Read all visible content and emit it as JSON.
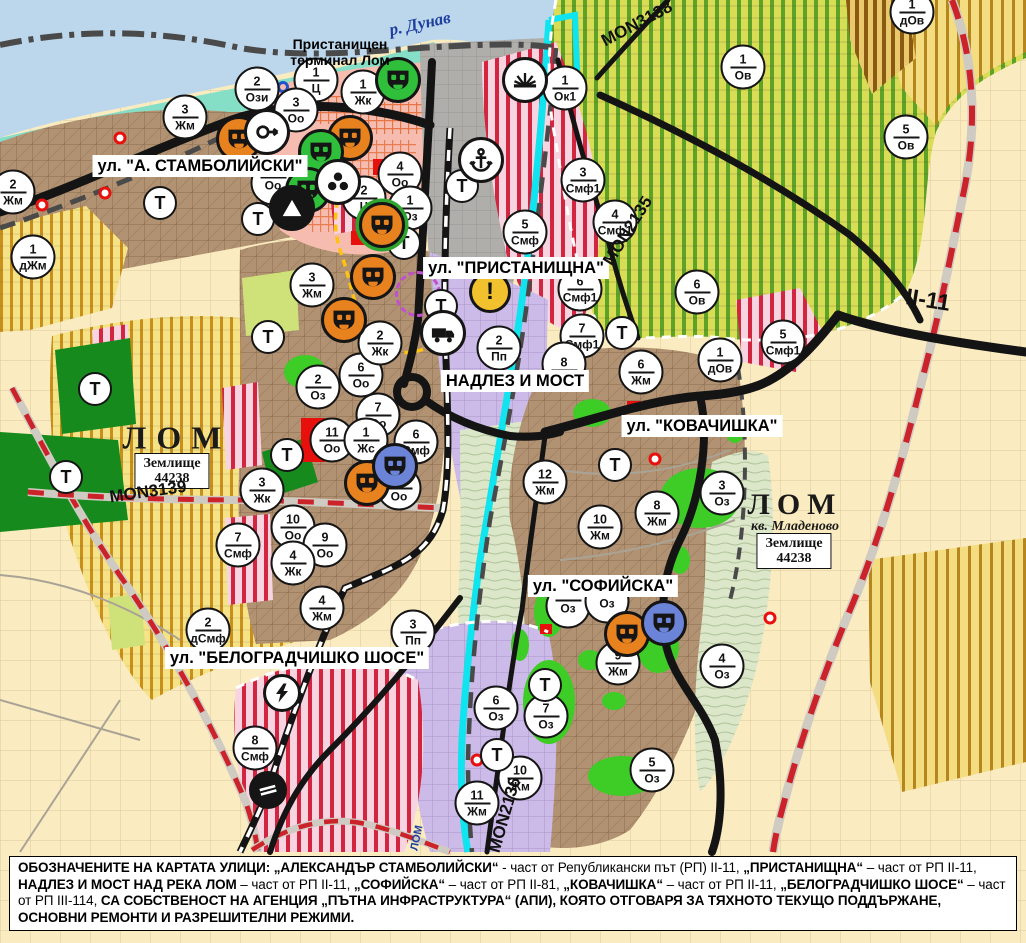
{
  "colors": {
    "water": "#BCD7EC",
    "shore": "#85DEC6",
    "port_gray": "#B0AEAB",
    "plain": "#FAEBC0",
    "brown_urban": "#B19272",
    "purple_zone": "#CCBAE8",
    "salmon_center": "#F6BCB0",
    "terrace": "#DCE7CA",
    "yellow_hatch_bg": "#F6E387",
    "yellow_hatch_stripe": "#C98F1B",
    "green_hatch_bg": "#D9DC55",
    "green_hatch_stripe": "#5EA227",
    "ochre_hatch_bg": "#F4DC80",
    "ochre_hatch_stripe": "#B5851E",
    "red_stripe_bg": "#F7D4DF",
    "red_stripe": "#D22640",
    "bright_green": "#3ECC27",
    "dark_green": "#168A1C",
    "lime": "#CFE27A",
    "red_patch": "#E8100C",
    "cyan_river": "#10E4EF",
    "road_black": "#141414",
    "road_red_dash": "#CC2229",
    "marker_orange": "#E8821E",
    "marker_green": "#2FBF3A",
    "marker_blue": "#6C84D8",
    "warn_yellow": "#F2C12E"
  },
  "labels": [
    {
      "t": "ул. \"А. СТАМБОЛИЙСКИ\"",
      "x": 200,
      "y": 166,
      "cls": "street",
      "rot": 0,
      "name": "street-label-stamboliyski"
    },
    {
      "t": "ул. \"ПРИСТАНИЩНА\"",
      "x": 516,
      "y": 268,
      "cls": "street",
      "rot": 0,
      "name": "street-label-pristanishtna"
    },
    {
      "t": "НАДЛЕЗ И МОСТ",
      "x": 515,
      "y": 381,
      "cls": "street",
      "rot": 0,
      "name": "street-label-nadlez-i-most"
    },
    {
      "t": "ул. \"КОВАЧИШКА\"",
      "x": 702,
      "y": 426,
      "cls": "street",
      "rot": 0,
      "name": "street-label-kovachishka"
    },
    {
      "t": "ул. \"СОФИЙСКА\"",
      "x": 603,
      "y": 586,
      "cls": "street",
      "rot": 0,
      "name": "street-label-sofiyska"
    },
    {
      "t": "ул. \"БЕЛОГРАДЧИШКО ШОСЕ\"",
      "x": 297,
      "y": 658,
      "cls": "street",
      "rot": 0,
      "name": "street-label-belogradchishko"
    },
    {
      "t": "р. Дунав",
      "x": 420,
      "y": 24,
      "cls": "river",
      "rot": -12,
      "name": "river-danube-label"
    },
    {
      "t": "ЛОМ",
      "x": 417,
      "y": 838,
      "cls": "riversmall",
      "rot": -78,
      "name": "river-lom-label"
    },
    {
      "t": "Пристанищен\nтерминал Лом",
      "x": 340,
      "y": 52,
      "cls": "terminal",
      "rot": 0,
      "name": "port-terminal-label"
    },
    {
      "t": "ЛОМ",
      "x": 177,
      "y": 438,
      "cls": "city",
      "rot": 0,
      "name": "city-label-lom"
    },
    {
      "t": "ЛОМ",
      "x": 795,
      "y": 505,
      "cls": "city2",
      "rot": 0,
      "name": "city-label-lom-mladenovo"
    },
    {
      "t": "кв. Младеново",
      "x": 795,
      "y": 527,
      "cls": "district",
      "rot": 0,
      "name": "district-label-mladenovo"
    },
    {
      "t": "Землище\n44238",
      "x": 172,
      "y": 471,
      "cls": "zembox",
      "rot": 0,
      "name": "land-unit-box-west"
    },
    {
      "t": "Землище\n44238",
      "x": 794,
      "y": 551,
      "cls": "zembox",
      "rot": 0,
      "name": "land-unit-box-east"
    },
    {
      "t": "MON3139",
      "x": 148,
      "y": 492,
      "cls": "roadref",
      "rot": -8,
      "name": "road-ref-mon3139"
    },
    {
      "t": "MON3138",
      "x": 637,
      "y": 24,
      "cls": "roadref",
      "rot": -28,
      "name": "road-ref-mon3138"
    },
    {
      "t": "MON2135",
      "x": 628,
      "y": 231,
      "cls": "roadref",
      "rot": -58,
      "name": "road-ref-mon2135"
    },
    {
      "t": "MON2136",
      "x": 505,
      "y": 815,
      "cls": "roadref",
      "rot": -74,
      "name": "road-ref-mon2136"
    },
    {
      "t": "II-11",
      "x": 928,
      "y": 300,
      "cls": "highway",
      "rot": 9,
      "name": "road-ref-ii-11"
    }
  ],
  "markers": {
    "zones": [
      {
        "x": 257,
        "y": 89,
        "n": "2",
        "c": "Ози"
      },
      {
        "x": 316,
        "y": 80,
        "n": "1",
        "c": "Ц"
      },
      {
        "x": 363,
        "y": 92,
        "n": "1",
        "c": "Жк"
      },
      {
        "x": 296,
        "y": 110,
        "n": "3",
        "c": "Оо"
      },
      {
        "x": 185,
        "y": 117,
        "n": "3",
        "c": "Жм"
      },
      {
        "x": 13,
        "y": 192,
        "n": "2",
        "c": "Жм"
      },
      {
        "x": 33,
        "y": 257,
        "n": "1",
        "c": "дЖм"
      },
      {
        "x": 400,
        "y": 174,
        "n": "4",
        "c": "Оо"
      },
      {
        "x": 364,
        "y": 198,
        "n": "2",
        "c": "Ц"
      },
      {
        "x": 410,
        "y": 208,
        "n": "1",
        "c": "Оз"
      },
      {
        "x": 273,
        "y": 183,
        "n": "",
        "c": "Оо"
      },
      {
        "x": 312,
        "y": 285,
        "n": "3",
        "c": "Жм"
      },
      {
        "x": 318,
        "y": 387,
        "n": "2",
        "c": "Оз"
      },
      {
        "x": 361,
        "y": 375,
        "n": "6",
        "c": "Оо"
      },
      {
        "x": 378,
        "y": 415,
        "n": "7",
        "c": "Оо"
      },
      {
        "x": 332,
        "y": 440,
        "n": "11",
        "c": "Оо"
      },
      {
        "x": 366,
        "y": 440,
        "n": "1",
        "c": "Жс"
      },
      {
        "x": 416,
        "y": 442,
        "n": "6",
        "c": "Смф"
      },
      {
        "x": 399,
        "y": 488,
        "n": "8",
        "c": "Оо"
      },
      {
        "x": 262,
        "y": 490,
        "n": "3",
        "c": "Жк"
      },
      {
        "x": 293,
        "y": 527,
        "n": "10",
        "c": "Оо"
      },
      {
        "x": 325,
        "y": 545,
        "n": "9",
        "c": "Оо"
      },
      {
        "x": 293,
        "y": 563,
        "n": "4",
        "c": "Жк"
      },
      {
        "x": 238,
        "y": 545,
        "n": "7",
        "c": "Смф"
      },
      {
        "x": 322,
        "y": 608,
        "n": "4",
        "c": "Жм"
      },
      {
        "x": 208,
        "y": 630,
        "n": "2",
        "c": "дСмф"
      },
      {
        "x": 413,
        "y": 632,
        "n": "3",
        "c": "Пп"
      },
      {
        "x": 255,
        "y": 748,
        "n": "8",
        "c": "Смф"
      },
      {
        "x": 380,
        "y": 343,
        "n": "2",
        "c": "Жк"
      },
      {
        "x": 565,
        "y": 88,
        "n": "1",
        "c": "Ок1"
      },
      {
        "x": 583,
        "y": 180,
        "n": "3",
        "c": "Смф1"
      },
      {
        "x": 615,
        "y": 222,
        "n": "4",
        "c": "Смф1"
      },
      {
        "x": 525,
        "y": 232,
        "n": "5",
        "c": "Смф"
      },
      {
        "x": 580,
        "y": 289,
        "n": "6",
        "c": "Смф1"
      },
      {
        "x": 499,
        "y": 348,
        "n": "2",
        "c": "Пп"
      },
      {
        "x": 582,
        "y": 336,
        "n": "7",
        "c": "Смф1"
      },
      {
        "x": 564,
        "y": 364,
        "n": "8",
        "c": ""
      },
      {
        "x": 641,
        "y": 372,
        "n": "6",
        "c": "Жм"
      },
      {
        "x": 720,
        "y": 360,
        "n": "1",
        "c": "дОв"
      },
      {
        "x": 783,
        "y": 342,
        "n": "5",
        "c": "Смф1"
      },
      {
        "x": 697,
        "y": 292,
        "n": "6",
        "c": "Ов"
      },
      {
        "x": 743,
        "y": 67,
        "n": "1",
        "c": "Ов"
      },
      {
        "x": 906,
        "y": 137,
        "n": "5",
        "c": "Ов"
      },
      {
        "x": 912,
        "y": 12,
        "n": "1",
        "c": "дОв"
      },
      {
        "x": 657,
        "y": 513,
        "n": "8",
        "c": "Жм"
      },
      {
        "x": 545,
        "y": 482,
        "n": "12",
        "c": "Жм"
      },
      {
        "x": 600,
        "y": 527,
        "n": "10",
        "c": "Жм"
      },
      {
        "x": 722,
        "y": 493,
        "n": "3",
        "c": "Оз"
      },
      {
        "x": 618,
        "y": 663,
        "n": "9",
        "c": "Жм"
      },
      {
        "x": 722,
        "y": 666,
        "n": "4",
        "c": "Оз"
      },
      {
        "x": 496,
        "y": 708,
        "n": "6",
        "c": "Оз"
      },
      {
        "x": 546,
        "y": 716,
        "n": "7",
        "c": "Оз"
      },
      {
        "x": 520,
        "y": 778,
        "n": "10",
        "c": "Жм"
      },
      {
        "x": 477,
        "y": 803,
        "n": "11",
        "c": "Жм"
      },
      {
        "x": 652,
        "y": 770,
        "n": "5",
        "c": "Оз"
      },
      {
        "x": 568,
        "y": 606,
        "n": "",
        "c": "Оз"
      },
      {
        "x": 607,
        "y": 601,
        "n": "",
        "c": "Оз"
      }
    ],
    "t_circles": [
      [
        160,
        203
      ],
      [
        258,
        219
      ],
      [
        268,
        337
      ],
      [
        95,
        389
      ],
      [
        66,
        477
      ],
      [
        287,
        455
      ],
      [
        404,
        243
      ],
      [
        462,
        186
      ],
      [
        441,
        306
      ],
      [
        622,
        333
      ],
      [
        615,
        465
      ],
      [
        545,
        685
      ],
      [
        497,
        755
      ]
    ],
    "icons": [
      {
        "x": 239,
        "y": 139,
        "k": "maskO"
      },
      {
        "x": 350,
        "y": 138,
        "k": "maskO"
      },
      {
        "x": 373,
        "y": 277,
        "k": "maskO"
      },
      {
        "x": 344,
        "y": 320,
        "k": "maskO"
      },
      {
        "x": 382,
        "y": 225,
        "k": "maskOG"
      },
      {
        "x": 367,
        "y": 483,
        "k": "maskO"
      },
      {
        "x": 627,
        "y": 634,
        "k": "maskO"
      },
      {
        "x": 321,
        "y": 152,
        "k": "maskG"
      },
      {
        "x": 308,
        "y": 190,
        "k": "maskG"
      },
      {
        "x": 398,
        "y": 80,
        "k": "maskG"
      },
      {
        "x": 395,
        "y": 466,
        "k": "maskB"
      },
      {
        "x": 664,
        "y": 623,
        "k": "maskB"
      },
      {
        "x": 267,
        "y": 132,
        "k": "arrow"
      },
      {
        "x": 338,
        "y": 182,
        "k": "clover"
      },
      {
        "x": 292,
        "y": 208,
        "k": "tri"
      },
      {
        "x": 525,
        "y": 80,
        "k": "sun"
      },
      {
        "x": 481,
        "y": 160,
        "k": "anchor"
      },
      {
        "x": 443,
        "y": 333,
        "k": "truck"
      },
      {
        "x": 282,
        "y": 693,
        "k": "bolt"
      },
      {
        "x": 268,
        "y": 790,
        "k": "rail"
      },
      {
        "x": 490,
        "y": 292,
        "k": "warn"
      }
    ],
    "dots": [
      {
        "x": 120,
        "y": 138,
        "k": "red"
      },
      {
        "x": 105,
        "y": 193,
        "k": "red"
      },
      {
        "x": 42,
        "y": 205,
        "k": "red"
      },
      {
        "x": 655,
        "y": 459,
        "k": "red"
      },
      {
        "x": 477,
        "y": 760,
        "k": "red"
      },
      {
        "x": 770,
        "y": 618,
        "k": "red"
      },
      {
        "x": 283,
        "y": 87,
        "k": "blue"
      },
      {
        "x": 418,
        "y": 294,
        "k": "dash"
      }
    ]
  },
  "caption": {
    "segments": [
      {
        "bold": true,
        "text": "ОБОЗНАЧЕНИТЕ НА КАРТАТА УЛИЦИ: „АЛЕКСАНДЪР СТАМБОЛИЙСКИ“"
      },
      {
        "bold": false,
        "text": " - част от Републикански път (РП) II-11, "
      },
      {
        "bold": true,
        "text": "„ПРИСТАНИЩНА“"
      },
      {
        "bold": false,
        "text": " – част от РП II-11, "
      },
      {
        "bold": true,
        "text": "НАДЛЕЗ И МОСТ НАД РЕКА ЛОМ"
      },
      {
        "bold": false,
        "text": " – част от РП II-11, "
      },
      {
        "bold": true,
        "text": "„СОФИЙСКА“"
      },
      {
        "bold": false,
        "text": " – част от РП II-81, "
      },
      {
        "bold": true,
        "text": "„КОВАЧИШКА“"
      },
      {
        "bold": false,
        "text": " – част от РП II-11, "
      },
      {
        "bold": true,
        "text": "„БЕЛОГРАДЧИШКО ШОСЕ“"
      },
      {
        "bold": false,
        "text": " – част от РП III-114, "
      },
      {
        "bold": true,
        "text": "СА СОБСТВЕНОСТ НА АГЕНЦИЯ „ПЪТНА ИНФРАСТРУКТУРА“ (АПИ), КОЯТО ОТГОВАРЯ ЗА ТЯХНОТО ТЕКУЩО ПОДДЪРЖАНЕ, ОСНОВНИ РЕМОНТИ И РАЗРЕШИТЕЛНИ РЕЖИМИ."
      }
    ]
  }
}
